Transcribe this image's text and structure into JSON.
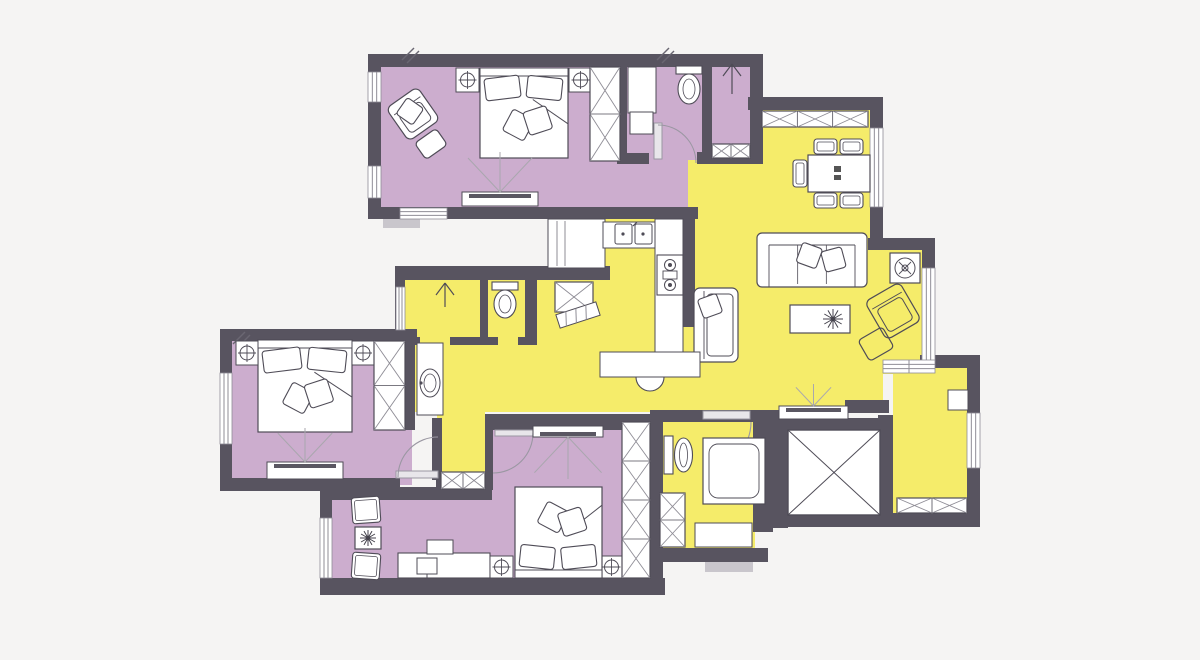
{
  "meta": {
    "kind": "apartment-floor-plan",
    "width": 1200,
    "height": 660
  },
  "palette": {
    "background": "#f5f4f3",
    "wall": "#585460",
    "room_private": "#ccadce",
    "room_living": "#f5ec6a",
    "furniture_fill": "#ffffff",
    "furniture_stroke": "#4f4c57",
    "xline": "#8f8d96",
    "arc": "#9a97a2",
    "threshold": "#c9c6cc",
    "fan": "#a9a7ae"
  },
  "rooms": [
    {
      "id": "master-bedroom",
      "fill": "room_private",
      "rects": [
        [
          375,
          60,
          318,
          150
        ]
      ]
    },
    {
      "id": "ensuite-bathroom",
      "fill": "room_private",
      "rects": [
        [
          617,
          60,
          95,
          100
        ]
      ]
    },
    {
      "id": "shower-room",
      "fill": "room_private",
      "rects": [
        [
          705,
          60,
          50,
          102
        ]
      ]
    },
    {
      "id": "left-bedroom",
      "fill": "room_private",
      "rects": [
        [
          226,
          335,
          186,
          150
        ]
      ]
    },
    {
      "id": "bottom-bedroom",
      "fill": "room_private",
      "rects": [
        [
          326,
          487,
          332,
          102
        ],
        [
          490,
          421,
          168,
          72
        ]
      ]
    },
    {
      "id": "dining-area",
      "fill": "room_living",
      "rects": [
        [
          757,
          108,
          116,
          132
        ]
      ]
    },
    {
      "id": "hall-top",
      "fill": "room_living",
      "rects": [
        [
          688,
          160,
          74,
          80
        ]
      ]
    },
    {
      "id": "living-kitchen",
      "fill": "room_living",
      "rects": [
        [
          605,
          217,
          267,
          195
        ]
      ]
    },
    {
      "id": "living-right",
      "fill": "room_living",
      "rects": [
        [
          868,
          250,
          54,
          124
        ],
        [
          868,
          374,
          15,
          34
        ]
      ]
    },
    {
      "id": "hall-left",
      "fill": "room_living",
      "rects": [
        [
          412,
          340,
          200,
          72
        ]
      ]
    },
    {
      "id": "corridor",
      "fill": "room_living",
      "rects": [
        [
          437,
          390,
          48,
          97
        ]
      ]
    },
    {
      "id": "middle-bathroom",
      "fill": "room_living",
      "rects": [
        [
          403,
          270,
          202,
          75
        ]
      ]
    },
    {
      "id": "bottom-bathroom",
      "fill": "room_living",
      "rects": [
        [
          663,
          420,
          92,
          128
        ]
      ]
    },
    {
      "id": "balcony",
      "fill": "room_living",
      "rects": [
        [
          893,
          368,
          74,
          146
        ]
      ]
    }
  ],
  "walls": [
    [
      368,
      54,
      394,
      13
    ],
    [
      368,
      54,
      13,
      165
    ],
    [
      368,
      207,
      330,
      12
    ],
    [
      617,
      62,
      10,
      98
    ],
    [
      702,
      54,
      10,
      110
    ],
    [
      750,
      54,
      13,
      110
    ],
    [
      697,
      152,
      66,
      12
    ],
    [
      617,
      153,
      32,
      11
    ],
    [
      748,
      97,
      135,
      13
    ],
    [
      870,
      97,
      13,
      153
    ],
    [
      868,
      238,
      67,
      12
    ],
    [
      922,
      238,
      13,
      134
    ],
    [
      920,
      355,
      60,
      13
    ],
    [
      967,
      355,
      13,
      172
    ],
    [
      878,
      513,
      102,
      14
    ],
    [
      878,
      415,
      15,
      112
    ],
    [
      683,
      217,
      12,
      110
    ],
    [
      678,
      410,
      101,
      12
    ],
    [
      845,
      400,
      44,
      13
    ],
    [
      403,
      266,
      207,
      14
    ],
    [
      395,
      266,
      10,
      82
    ],
    [
      480,
      280,
      8,
      60
    ],
    [
      525,
      280,
      12,
      60
    ],
    [
      403,
      337,
      17,
      8
    ],
    [
      450,
      337,
      48,
      8
    ],
    [
      518,
      337,
      19,
      8
    ],
    [
      220,
      329,
      197,
      12
    ],
    [
      220,
      329,
      12,
      162
    ],
    [
      403,
      329,
      12,
      101
    ],
    [
      220,
      478,
      127,
      13
    ],
    [
      340,
      478,
      60,
      13
    ],
    [
      436,
      478,
      8,
      13
    ],
    [
      432,
      418,
      10,
      62
    ],
    [
      485,
      417,
      8,
      73
    ],
    [
      485,
      414,
      178,
      16
    ],
    [
      332,
      487,
      160,
      13
    ],
    [
      320,
      487,
      12,
      104
    ],
    [
      320,
      578,
      345,
      17
    ],
    [
      650,
      414,
      13,
      181
    ],
    [
      650,
      410,
      53,
      12
    ],
    [
      750,
      410,
      27,
      12
    ],
    [
      753,
      410,
      20,
      122
    ],
    [
      650,
      548,
      118,
      14
    ],
    [
      773,
      418,
      120,
      12
    ],
    [
      773,
      418,
      15,
      110
    ],
    [
      773,
      515,
      120,
      12
    ]
  ],
  "windows": [
    {
      "r": [
        368,
        72,
        13,
        30
      ],
      "dir": "v"
    },
    {
      "r": [
        368,
        166,
        13,
        32
      ],
      "dir": "v"
    },
    {
      "r": [
        400,
        208,
        47,
        11
      ],
      "dir": "h"
    },
    {
      "r": [
        870,
        128,
        13,
        79
      ],
      "dir": "v"
    },
    {
      "r": [
        922,
        268,
        13,
        94
      ],
      "dir": "v"
    },
    {
      "r": [
        967,
        413,
        13,
        55
      ],
      "dir": "v"
    },
    {
      "r": [
        220,
        373,
        12,
        71
      ],
      "dir": "v"
    },
    {
      "r": [
        320,
        518,
        12,
        60
      ],
      "dir": "v"
    },
    {
      "r": [
        396,
        287,
        9,
        43
      ],
      "dir": "v"
    }
  ],
  "doors": [
    {
      "leaf": [
        654,
        123,
        8,
        36
      ],
      "arc": "M 658 125 A 38 38 0 0 1 696 163"
    },
    {
      "leaf": [
        396,
        471,
        42,
        7
      ],
      "arc": "M 398 477 A 40 40 0 0 1 438 437"
    },
    {
      "leaf": [
        495,
        430,
        38,
        6
      ],
      "arc": "M 533 433 A 40 40 0 0 1 493 473"
    },
    {
      "leaf": [
        703,
        411,
        47,
        8
      ],
      "arc": "M 751 422 A 48 48 0 0 1 703 470"
    }
  ],
  "thresholds": [
    [
      383,
      219,
      37,
      9
    ],
    [
      705,
      562,
      48,
      10
    ]
  ],
  "ticks": [
    [
      402,
      48
    ],
    [
      657,
      48
    ],
    [
      233,
      332
    ]
  ],
  "furniture": [
    {
      "t": "armchair",
      "x": 394,
      "y": 94,
      "w": 38,
      "h": 40,
      "rot": -35,
      "cx": 413,
      "cy": 114,
      "pillow": true
    },
    {
      "t": "ottoman",
      "x": 418,
      "y": 134,
      "w": 26,
      "h": 20,
      "rot": -35,
      "cx": 431,
      "cy": 144
    },
    {
      "t": "bed",
      "x": 480,
      "y": 68,
      "w": 88,
      "h": 90,
      "head": "top"
    },
    {
      "t": "nightstand",
      "x": 456,
      "y": 68,
      "w": 23,
      "h": 24
    },
    {
      "t": "nightstand",
      "x": 569,
      "y": 68,
      "w": 23,
      "h": 24
    },
    {
      "t": "wardrobe",
      "x": 590,
      "y": 67,
      "w": 30,
      "h": 94,
      "cells": 2,
      "dir": "v"
    },
    {
      "t": "tvstand",
      "x": 462,
      "y": 192,
      "w": 76,
      "h": 14,
      "fan": "up",
      "flen": 40
    },
    {
      "t": "counter",
      "x": 628,
      "y": 67,
      "w": 28,
      "h": 46
    },
    {
      "t": "counter",
      "x": 630,
      "y": 112,
      "w": 23,
      "h": 22
    },
    {
      "t": "toilet",
      "x": 676,
      "y": 66,
      "w": 26,
      "h": 38,
      "orient": "down"
    },
    {
      "t": "arrow",
      "cx": 732,
      "y": 64,
      "len": 30
    },
    {
      "t": "wardrobe",
      "x": 712,
      "y": 144,
      "w": 38,
      "h": 14,
      "cells": 2,
      "dir": "h"
    },
    {
      "t": "wardrobe",
      "x": 762,
      "y": 111,
      "w": 106,
      "h": 16,
      "cells": 3,
      "dir": "h"
    },
    {
      "t": "table",
      "x": 808,
      "y": 155,
      "w": 62,
      "h": 37,
      "glyph": true
    },
    {
      "t": "chair",
      "x": 814,
      "y": 139,
      "w": 23,
      "h": 15
    },
    {
      "t": "chair",
      "x": 840,
      "y": 139,
      "w": 23,
      "h": 15
    },
    {
      "t": "chair",
      "x": 814,
      "y": 193,
      "w": 23,
      "h": 15
    },
    {
      "t": "chair",
      "x": 840,
      "y": 193,
      "w": 23,
      "h": 15
    },
    {
      "t": "chair",
      "x": 793,
      "y": 160,
      "w": 14,
      "h": 27
    },
    {
      "t": "sofa",
      "x": 757,
      "y": 233,
      "w": 110,
      "h": 54
    },
    {
      "t": "armchair",
      "x": 694,
      "y": 288,
      "w": 44,
      "h": 74,
      "facing": "right",
      "pillow": true
    },
    {
      "t": "coffeetable",
      "x": 790,
      "y": 305,
      "w": 60,
      "h": 28
    },
    {
      "t": "armchair",
      "x": 873,
      "y": 289,
      "w": 40,
      "h": 44,
      "rot": -30,
      "cx": 893,
      "cy": 311,
      "open": true
    },
    {
      "t": "ottoman",
      "x": 862,
      "y": 332,
      "w": 28,
      "h": 24,
      "rot": -30,
      "cx": 876,
      "cy": 344,
      "open": true
    },
    {
      "t": "washer",
      "x": 890,
      "y": 253,
      "w": 30,
      "h": 30
    },
    {
      "t": "tvstand",
      "x": 779,
      "y": 406,
      "w": 69,
      "h": 13,
      "fan": "up",
      "flen": 22
    },
    {
      "t": "counter",
      "x": 548,
      "y": 219,
      "w": 57,
      "h": 49,
      "lines": "v"
    },
    {
      "t": "counter",
      "x": 603,
      "y": 222,
      "w": 53,
      "h": 26
    },
    {
      "t": "sink2",
      "x": 615,
      "y": 224,
      "w": 38,
      "h": 22
    },
    {
      "t": "counter",
      "x": 655,
      "y": 219,
      "w": 28,
      "h": 158
    },
    {
      "t": "stove",
      "x": 657,
      "y": 255,
      "w": 26,
      "h": 40
    },
    {
      "t": "counter",
      "x": 600,
      "y": 352,
      "w": 100,
      "h": 25
    },
    {
      "t": "halfcircle",
      "cx": 650,
      "cy": 377,
      "r": 14
    },
    {
      "t": "wardrobe",
      "x": 555,
      "y": 282,
      "w": 38,
      "h": 30,
      "cells": 1,
      "dir": "v"
    },
    {
      "t": "bench",
      "x": 557,
      "y": 308,
      "w": 42,
      "h": 14,
      "rot": -18,
      "cx": 578,
      "cy": 315
    },
    {
      "t": "arrow",
      "cx": 445,
      "y": 283,
      "len": 24
    },
    {
      "t": "toilet",
      "x": 492,
      "y": 282,
      "w": 26,
      "h": 36,
      "orient": "down"
    },
    {
      "t": "vanity",
      "x": 417,
      "y": 343,
      "w": 26,
      "h": 72
    },
    {
      "t": "bed",
      "x": 258,
      "y": 340,
      "w": 94,
      "h": 92,
      "head": "top"
    },
    {
      "t": "nightstand",
      "x": 236,
      "y": 341,
      "w": 22,
      "h": 24
    },
    {
      "t": "nightstand",
      "x": 352,
      "y": 341,
      "w": 22,
      "h": 24
    },
    {
      "t": "wardrobe",
      "x": 374,
      "y": 341,
      "w": 31,
      "h": 89,
      "cells": 2,
      "dir": "v"
    },
    {
      "t": "tvstand",
      "x": 267,
      "y": 462,
      "w": 76,
      "h": 17,
      "fan": "up",
      "flen": 34
    },
    {
      "t": "wardrobe",
      "x": 441,
      "y": 472,
      "w": 44,
      "h": 17,
      "cells": 2,
      "dir": "h"
    },
    {
      "t": "chair",
      "x": 352,
      "y": 497,
      "w": 28,
      "h": 26,
      "rot": -4,
      "cx": 366,
      "cy": 510
    },
    {
      "t": "table",
      "x": 355,
      "y": 527,
      "w": 26,
      "h": 22,
      "plant": true
    },
    {
      "t": "chair",
      "x": 352,
      "y": 553,
      "w": 28,
      "h": 26,
      "rot": 4,
      "cx": 366,
      "cy": 566
    },
    {
      "t": "desk",
      "x": 398,
      "y": 553,
      "w": 92,
      "h": 25
    },
    {
      "t": "counter",
      "x": 427,
      "y": 540,
      "w": 26,
      "h": 14
    },
    {
      "t": "nightstand",
      "x": 490,
      "y": 556,
      "w": 23,
      "h": 22
    },
    {
      "t": "nightstand",
      "x": 600,
      "y": 556,
      "w": 23,
      "h": 22
    },
    {
      "t": "bed",
      "x": 515,
      "y": 487,
      "w": 87,
      "h": 91,
      "head": "bottom"
    },
    {
      "t": "wardrobe",
      "x": 622,
      "y": 422,
      "w": 28,
      "h": 156,
      "cells": 4,
      "dir": "v"
    },
    {
      "t": "tvstand",
      "x": 533,
      "y": 426,
      "w": 70,
      "h": 11,
      "fan": "down",
      "flen": 42
    },
    {
      "t": "toilet",
      "x": 664,
      "y": 432,
      "w": 24,
      "h": 46,
      "orient": "right"
    },
    {
      "t": "shower",
      "x": 703,
      "y": 438,
      "w": 62,
      "h": 66
    },
    {
      "t": "wardrobe",
      "x": 660,
      "y": 493,
      "w": 25,
      "h": 54,
      "cells": 2,
      "dir": "v"
    },
    {
      "t": "counter",
      "x": 695,
      "y": 523,
      "w": 57,
      "h": 24
    },
    {
      "t": "wardrobe",
      "x": 897,
      "y": 498,
      "w": 70,
      "h": 15,
      "cells": 2,
      "dir": "h"
    },
    {
      "t": "counter",
      "x": 948,
      "y": 390,
      "w": 20,
      "h": 20
    },
    {
      "t": "elevator",
      "x": 788,
      "y": 430,
      "w": 92,
      "h": 85
    },
    {
      "t": "slider",
      "x": 883,
      "y": 360,
      "w": 52,
      "h": 13
    }
  ]
}
